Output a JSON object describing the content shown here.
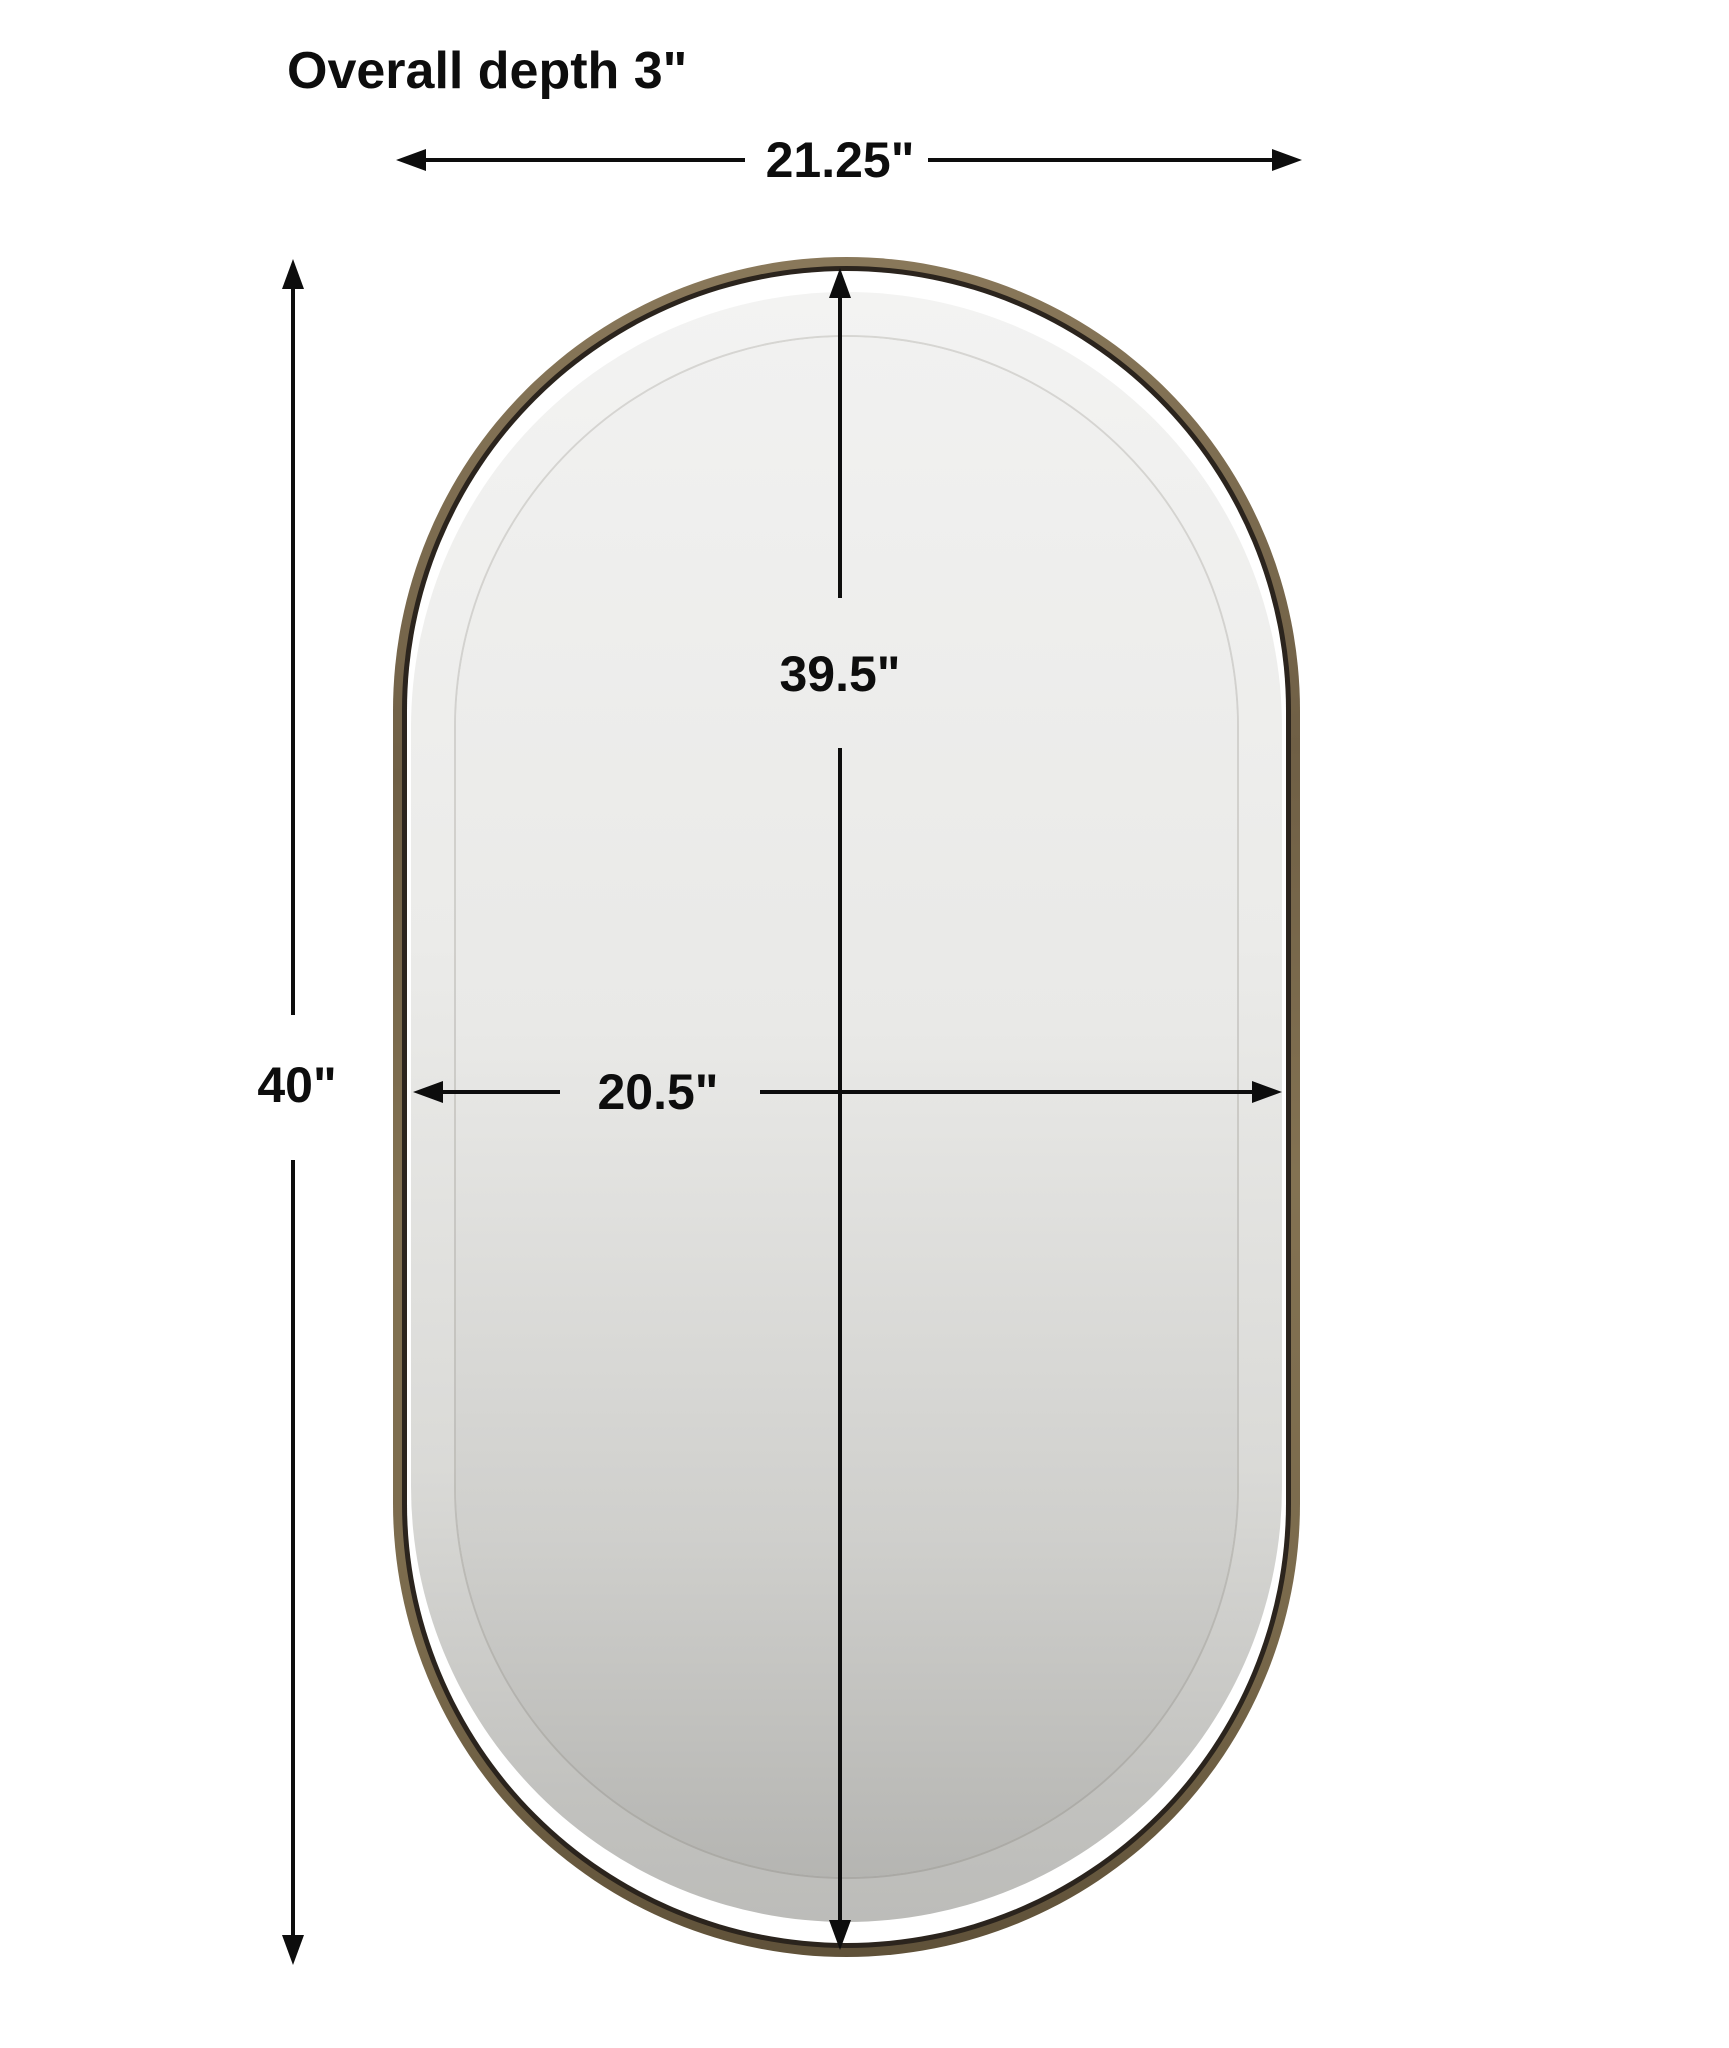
{
  "diagram": {
    "title": "Overall depth 3\"",
    "object": "oval-capsule-mirror-with-brass-frame",
    "dimensions": {
      "overall_width": {
        "label": "21.25\"",
        "orientation": "horizontal",
        "measures": "outer frame width"
      },
      "overall_height": {
        "label": "40\"",
        "orientation": "vertical",
        "measures": "outer frame height"
      },
      "glass_height": {
        "label": "39.5\"",
        "orientation": "vertical",
        "measures": "mirror glass height"
      },
      "glass_width": {
        "label": "20.5\"",
        "orientation": "horizontal",
        "measures": "mirror glass width"
      }
    },
    "colors": {
      "line": "#0d0d0d",
      "background": "#ffffff",
      "frame_brass_light": "#8a795b",
      "frame_brass_dark": "#5e5038",
      "frame_inner_edge": "#2b241d",
      "glass_top": "#f3f3f2",
      "glass_bottom": "#b5b5b2"
    }
  }
}
